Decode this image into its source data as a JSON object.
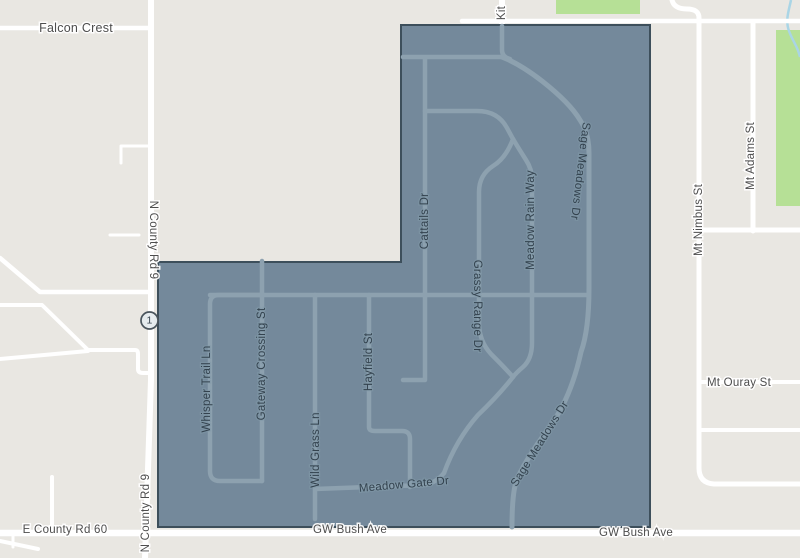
{
  "map": {
    "type": "street-map-with-neighborhood-boundary-overlay",
    "labels": {
      "falcon_crest": "Falcon Crest",
      "n_county_rd_9": "N County Rd 9",
      "e_county_rd_60": "E County Rd 60",
      "gw_bush_ave": "GW Bush Ave",
      "kit": "Kit",
      "mt_nimbus_st": "Mt Nimbus St",
      "mt_adams_st": "Mt Adams St",
      "mt_ouray_st": "Mt Ouray St",
      "whisper_trail_ln": "Whisper Trail Ln",
      "gateway_crossing_st": "Gateway Crossing St",
      "wild_grass_ln": "Wild Grass Ln",
      "hayfield_st": "Hayfield St",
      "cattails_dr": "Cattails Dr",
      "grassy_range_dr": "Grassy Range Dr",
      "meadow_rain_way": "Meadow Rain Way",
      "sage_meadows_dr": "Sage Meadows Dr",
      "meadow_gate_dr": "Meadow Gate Dr"
    },
    "marker": {
      "label": "1"
    },
    "colors": {
      "background": "#e9e7e2",
      "overlay_fill": "#74899b",
      "overlay_border": "#3d4f5b",
      "outside_road": "#ffffff",
      "inside_road": "#8da1af",
      "park": "#b6e096",
      "water": "#a9d5e6",
      "label_outside": "#4d4d4d",
      "label_inside": "#33424e"
    }
  }
}
